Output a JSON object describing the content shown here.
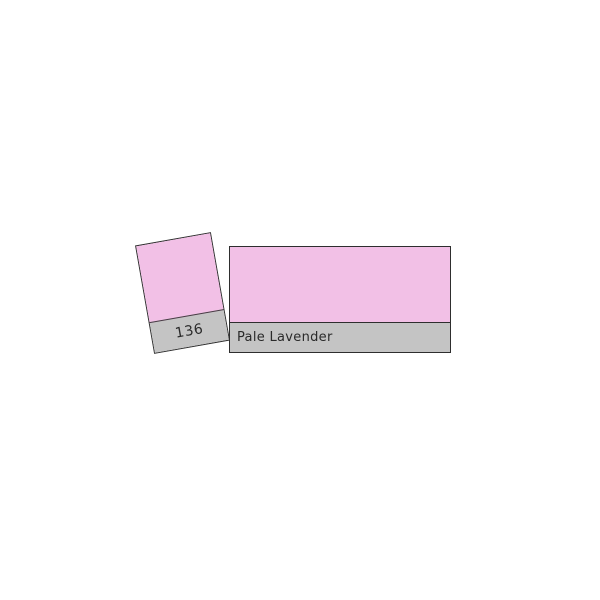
{
  "page": {
    "background_hex": "#ffffff"
  },
  "swatch_card": {
    "number": "136",
    "color_hex": "#f2c0e6",
    "strip_hex": "#c4c4c4"
  },
  "color_bar": {
    "name": "Pale Lavender",
    "color_hex": "#f2c0e6",
    "strip_hex": "#c4c4c4"
  },
  "colors": {
    "border_hex": "#2e2e2e",
    "text_hex": "#2a2a2a"
  }
}
